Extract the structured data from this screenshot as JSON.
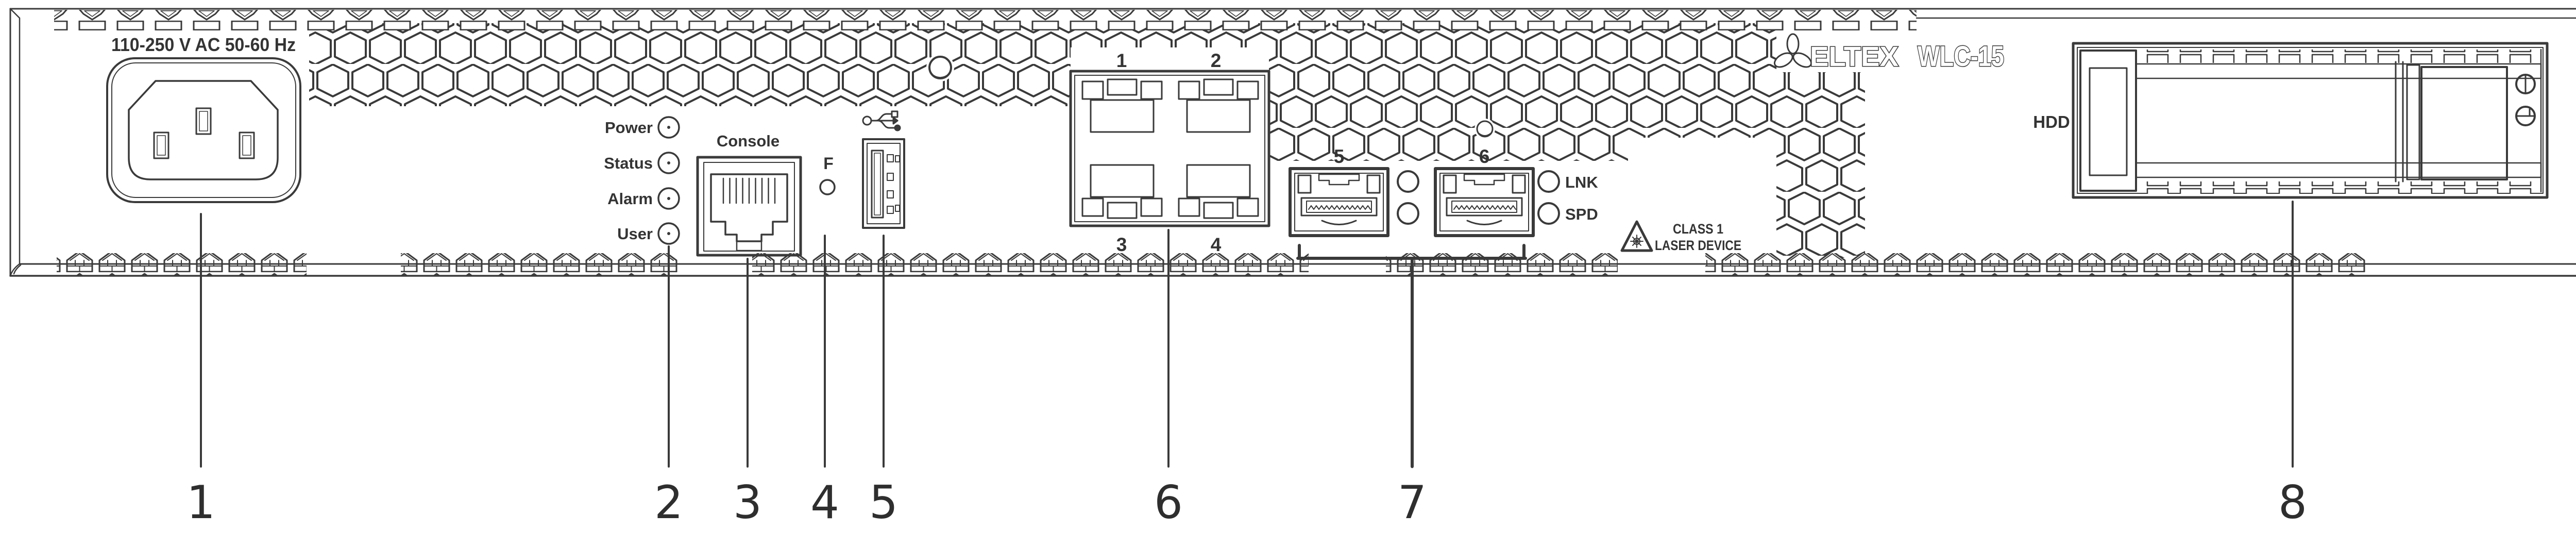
{
  "device": {
    "brand": "ELTEX",
    "model": "WLC-15"
  },
  "power": {
    "rating": "110-250 V AC  50-60 Hz"
  },
  "leds": {
    "items": [
      "Power",
      "Status",
      "Alarm",
      "User"
    ]
  },
  "console": {
    "label": "Console"
  },
  "function_button": {
    "label": "F"
  },
  "usb": {
    "icon": "usb-trident-icon"
  },
  "ethernet": {
    "port_labels": [
      "1",
      "2",
      "3",
      "4"
    ]
  },
  "sfp": {
    "port_labels": [
      "5",
      "6"
    ],
    "led_labels": [
      "LNK",
      "SPD"
    ]
  },
  "laser_warning": {
    "line1": "CLASS 1",
    "line2": "LASER DEVICE",
    "icon": "laser-warning-triangle-icon"
  },
  "hdd": {
    "label": "HDD"
  },
  "callouts": {
    "labels": [
      "1",
      "2",
      "3",
      "4",
      "5",
      "6",
      "7",
      "8"
    ]
  }
}
